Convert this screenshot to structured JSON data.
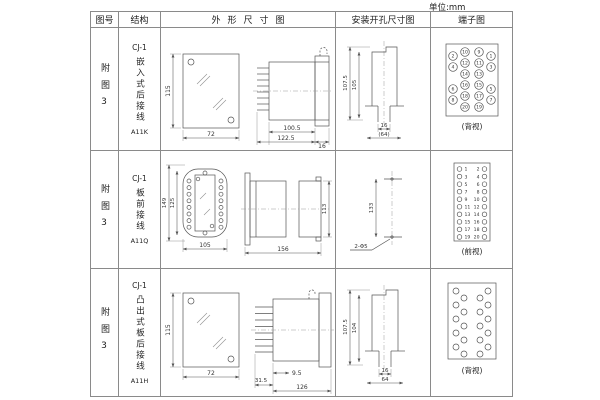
{
  "unit_label": "单位:mm",
  "table": {
    "headers": [
      "图号",
      "结构",
      "外形尺寸图",
      "安装开孔尺寸图",
      "端子图"
    ],
    "rows": [
      {
        "figure_no": "附图3",
        "structure": {
          "model": "CJ-1",
          "type": "嵌入式后接线",
          "code": "A11K"
        },
        "outline": {
          "front_height": "115",
          "front_width": "72",
          "body_depth": "100.5",
          "total_depth": "122.5",
          "flange_width": "16"
        },
        "mounting": {
          "outer_height": "107.5",
          "cutout_height": "105",
          "slot_width": "16",
          "overall_width": "(64)"
        },
        "terminal": {
          "view_label": "(背视)",
          "layout": "matrix",
          "inner_left": [
            10,
            12,
            14,
            16,
            18,
            20
          ],
          "inner_right": [
            9,
            11,
            13,
            15,
            17,
            19
          ],
          "outer_left": [
            2,
            4,
            6,
            8
          ],
          "outer_right": [
            1,
            3,
            5,
            7
          ]
        }
      },
      {
        "figure_no": "附图3",
        "structure": {
          "model": "CJ-1",
          "type": "板前接线",
          "code": "A11Q"
        },
        "outline": {
          "front_height": "149",
          "window_height": "125",
          "front_width": "105",
          "total_depth": "156",
          "rear_height": "113"
        },
        "mounting": {
          "hole_spacing": "133",
          "hole_callout": "2-Φ5"
        },
        "terminal": {
          "view_label": "(前视)",
          "layout": "dual",
          "left": [
            1,
            3,
            5,
            7,
            9,
            11,
            13,
            15,
            17,
            19
          ],
          "right": [
            2,
            4,
            6,
            8,
            10,
            12,
            14,
            16,
            18,
            20
          ]
        }
      },
      {
        "figure_no": "附图3",
        "structure": {
          "model": "CJ-1",
          "type": "凸出式板后接线",
          "code": "A11H"
        },
        "outline": {
          "front_height": "115",
          "front_width": "72",
          "pin_length": "31.5",
          "stub": "9.5",
          "body_depth": "126"
        },
        "mounting": {
          "outer_height": "107.5",
          "cutout_height": "104",
          "slot_width": "16",
          "overall_width": "64"
        },
        "terminal": {
          "view_label": "(背视)",
          "layout": "staggered"
        }
      }
    ]
  }
}
